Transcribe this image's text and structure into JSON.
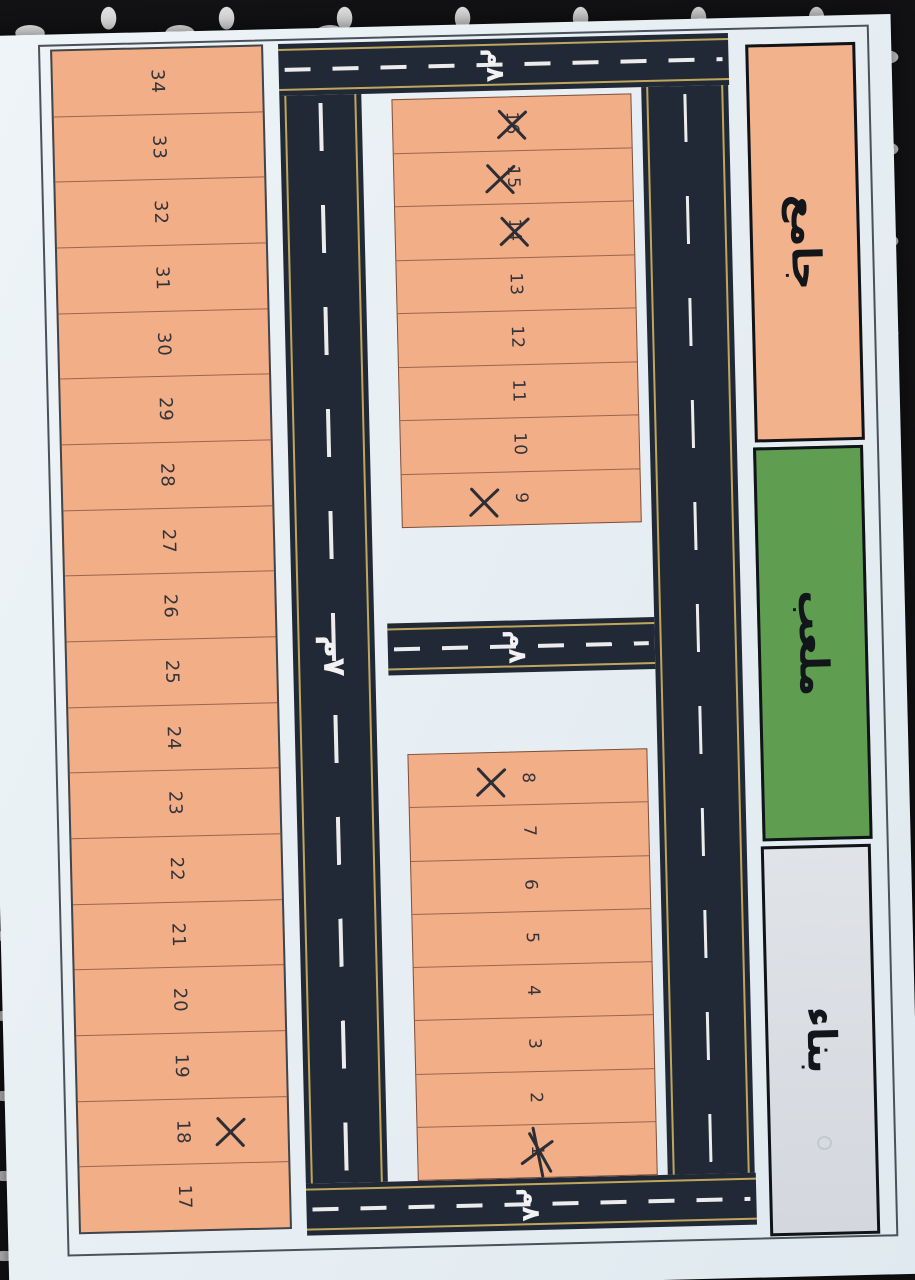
{
  "plan": {
    "left_strip": {
      "plots": [
        {
          "n": "34",
          "mark": ""
        },
        {
          "n": "33",
          "mark": ""
        },
        {
          "n": "32",
          "mark": ""
        },
        {
          "n": "31",
          "mark": ""
        },
        {
          "n": "30",
          "mark": ""
        },
        {
          "n": "29",
          "mark": ""
        },
        {
          "n": "28",
          "mark": ""
        },
        {
          "n": "27",
          "mark": ""
        },
        {
          "n": "26",
          "mark": ""
        },
        {
          "n": "25",
          "mark": ""
        },
        {
          "n": "24",
          "mark": ""
        },
        {
          "n": "23",
          "mark": ""
        },
        {
          "n": "22",
          "mark": ""
        },
        {
          "n": "21",
          "mark": ""
        },
        {
          "n": "20",
          "mark": ""
        },
        {
          "n": "19",
          "mark": ""
        },
        {
          "n": "18",
          "mark": "x-beside-right"
        },
        {
          "n": "17",
          "mark": ""
        }
      ]
    },
    "upper_block": {
      "plots": [
        {
          "n": "16",
          "mark": "x-over"
        },
        {
          "n": "15",
          "mark": "x-over"
        },
        {
          "n": "14",
          "mark": "x-over"
        },
        {
          "n": "13",
          "mark": ""
        },
        {
          "n": "12",
          "mark": ""
        },
        {
          "n": "11",
          "mark": ""
        },
        {
          "n": "10",
          "mark": ""
        },
        {
          "n": "9",
          "mark": "x-beside-left"
        }
      ]
    },
    "lower_block": {
      "plots": [
        {
          "n": "8",
          "mark": "x-beside-left"
        },
        {
          "n": "7",
          "mark": ""
        },
        {
          "n": "6",
          "mark": ""
        },
        {
          "n": "5",
          "mark": ""
        },
        {
          "n": "4",
          "mark": ""
        },
        {
          "n": "3",
          "mark": ""
        },
        {
          "n": "2",
          "mark": ""
        },
        {
          "n": "1",
          "mark": "x-scribble"
        }
      ]
    },
    "landmarks": [
      {
        "label": "جامع",
        "color": "#f2b28c"
      },
      {
        "label": "ملعب",
        "color": "#5f9e50"
      },
      {
        "label": "بناء",
        "color": "#d9dce1"
      }
    ],
    "roads": {
      "top": {
        "label": "٨م"
      },
      "middle": {
        "label": "٨م"
      },
      "bottom": {
        "label": "٨م"
      },
      "left_vertical": {
        "label": "٧م"
      }
    },
    "colors": {
      "plot_fill": "#f1ae87",
      "road": "#212936",
      "road_dash": "#ececec",
      "road_edge": "#bfa65c",
      "paper": "#e9f1f5",
      "mark": "#2d2d35"
    }
  }
}
